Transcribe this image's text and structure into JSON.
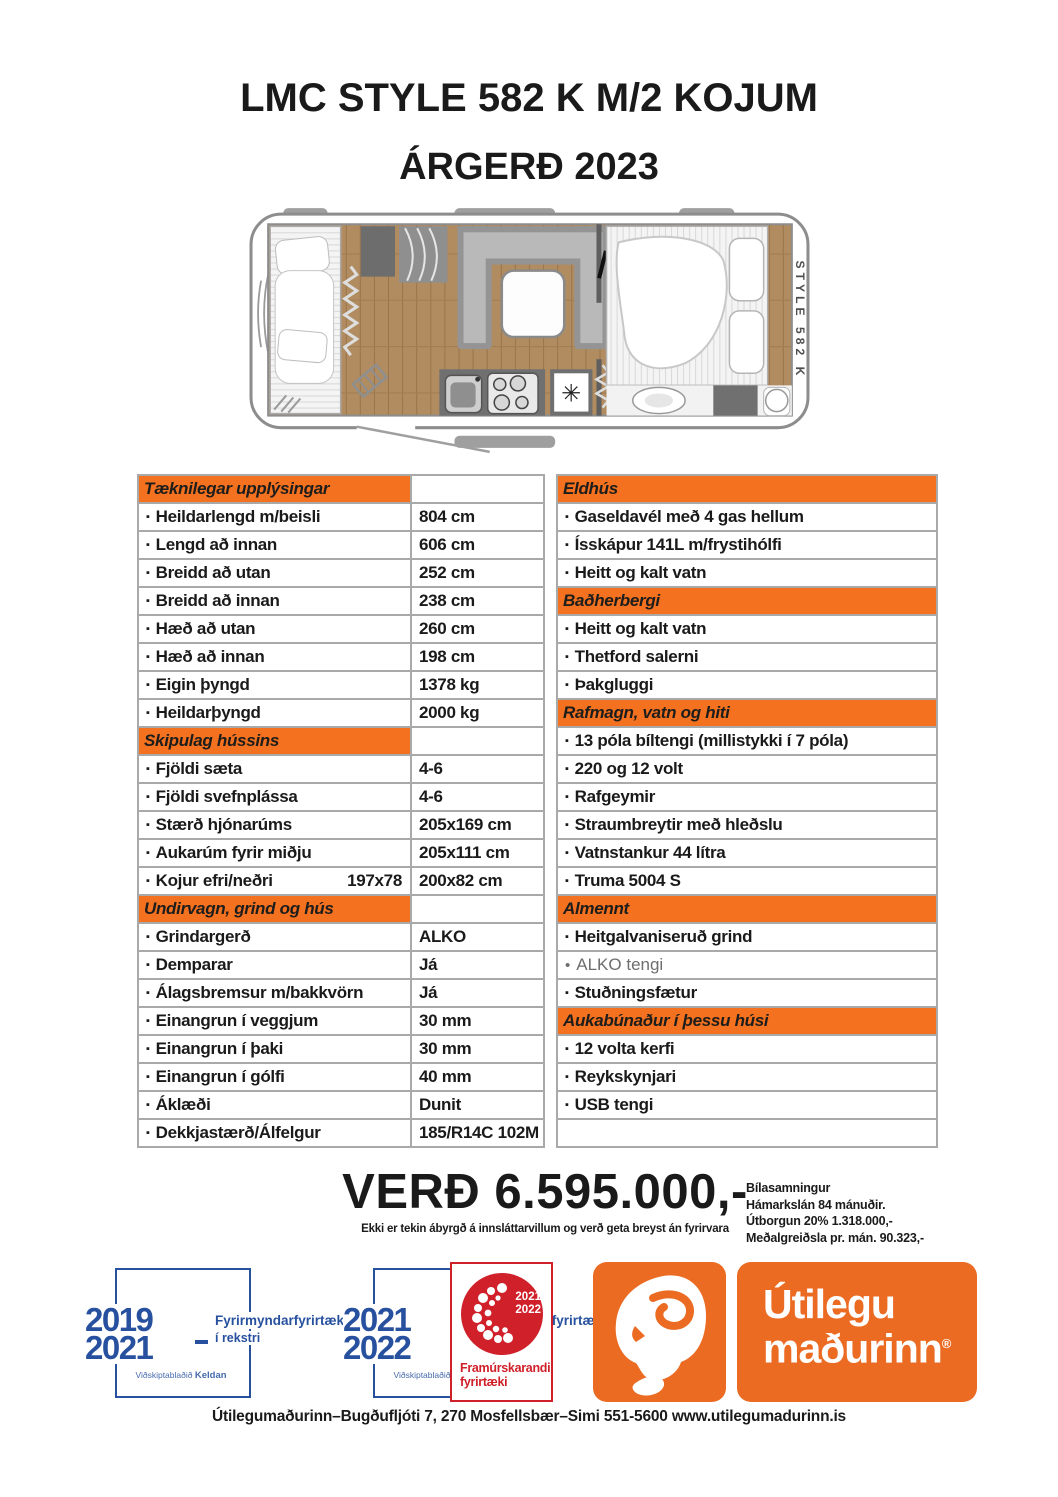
{
  "page": {
    "title_line1": "LMC STYLE 582 K M/2 KOJUM",
    "title_line2": "ÁRGERÐ 2023"
  },
  "floorplan": {
    "model_label": "STYLE 582 K",
    "tv_label": "TV",
    "freezer_symbol": "✳"
  },
  "bullets": {
    "square": "▪",
    "round": "•"
  },
  "specs": {
    "left": [
      {
        "type": "header",
        "label": "Tæknilegar upplýsingar"
      },
      {
        "type": "row",
        "label": "Heildarlengd m/beisli",
        "value": "804 cm"
      },
      {
        "type": "row",
        "label": "Lengd að innan",
        "value": "606 cm"
      },
      {
        "type": "row",
        "label": "Breidd að utan",
        "value": "252 cm"
      },
      {
        "type": "row",
        "label": "Breidd að innan",
        "value": "238 cm"
      },
      {
        "type": "row",
        "label": "Hæð að utan",
        "value": "260 cm"
      },
      {
        "type": "row",
        "label": "Hæð að innan",
        "value": "198 cm"
      },
      {
        "type": "row",
        "label": "Eigin þyngd",
        "value": "1378 kg"
      },
      {
        "type": "row",
        "label": "Heildarþyngd",
        "value": "2000 kg"
      },
      {
        "type": "header",
        "label": "Skipulag hússins"
      },
      {
        "type": "row",
        "label": "Fjöldi sæta",
        "value": "4-6"
      },
      {
        "type": "row",
        "label": "Fjöldi svefnplássa",
        "value": "4-6"
      },
      {
        "type": "row",
        "label": "Stærð hjónarúms",
        "value": "205x169 cm"
      },
      {
        "type": "row",
        "label": "Aukarúm fyrir miðju",
        "value": "205x111 cm"
      },
      {
        "type": "row",
        "label": "Kojur efri/neðri",
        "label2": "197x78",
        "value": "200x82 cm"
      },
      {
        "type": "header",
        "label": "Undirvagn, grind og hús"
      },
      {
        "type": "row",
        "label": "Grindargerð",
        "value": "ALKO"
      },
      {
        "type": "row",
        "label": "Demparar",
        "value": "Já"
      },
      {
        "type": "row",
        "label": "Álagsbremsur m/bakkvörn",
        "value": "Já"
      },
      {
        "type": "row",
        "label": "Einangrun í veggjum",
        "value": "30 mm"
      },
      {
        "type": "row",
        "label": "Einangrun í þaki",
        "value": "30 mm"
      },
      {
        "type": "row",
        "label": "Einangrun í gólfi",
        "value": "40 mm"
      },
      {
        "type": "row",
        "label": "Áklæði",
        "value": "Dunit"
      },
      {
        "type": "row",
        "label": "Dekkjastærð/Álfelgur",
        "value": "185/R14C 102M"
      }
    ],
    "right": [
      {
        "type": "header",
        "label": "Eldhús"
      },
      {
        "type": "row",
        "label": "Gaseldavél með 4 gas hellum"
      },
      {
        "type": "row",
        "label": "Ísskápur 141L m/frystihólfi"
      },
      {
        "type": "row",
        "label": "Heitt og kalt vatn"
      },
      {
        "type": "header",
        "label": "Baðherbergi"
      },
      {
        "type": "row",
        "label": "Heitt og kalt vatn"
      },
      {
        "type": "row",
        "label": "Thetford salerni"
      },
      {
        "type": "row",
        "label": "Þakgluggi"
      },
      {
        "type": "header",
        "label": "Rafmagn, vatn og hiti"
      },
      {
        "type": "row",
        "label": "13 póla bíltengi (millistykki í 7 póla)"
      },
      {
        "type": "row",
        "label": "220 og 12 volt"
      },
      {
        "type": "row",
        "label": "Rafgeymir"
      },
      {
        "type": "row",
        "label": "Straumbreytir með hleðslu"
      },
      {
        "type": "row",
        "label": "Vatnstankur 44 lítra"
      },
      {
        "type": "row",
        "label": "Truma 5004 S"
      },
      {
        "type": "header",
        "label": "Almennt"
      },
      {
        "type": "row",
        "label": "Heitgalvaniseruð grind"
      },
      {
        "type": "row",
        "label": "ALKO tengi",
        "muted": true
      },
      {
        "type": "row",
        "label": "Stuðningsfætur"
      },
      {
        "type": "header",
        "label": "Aukabúnaður í þessu húsi"
      },
      {
        "type": "row",
        "label": "12 volta kerfi"
      },
      {
        "type": "row",
        "label": "Reykskynjari"
      },
      {
        "type": "row",
        "label": "USB tengi"
      },
      {
        "type": "empty"
      }
    ]
  },
  "price": {
    "amount_label": "VERÐ 6.595.000,-",
    "disclaimer": "Ekki er tekin ábyrgð á innsláttarvillum og verð geta breyst án fyrirvara"
  },
  "financing": {
    "lines": [
      "Bílasamningur",
      "Hámarkslán 84 mánuðir.",
      "Útborgun 20% 1.318.000,-",
      "Meðalgreiðsla pr. mán. 90.323,-"
    ]
  },
  "badges": {
    "award1": {
      "year_top": "2019",
      "year_bottom": "2021",
      "title": "Fyrirmyndarfyrirtæki",
      "subtitle": "í rekstri",
      "source": "Viðskiptablaðið",
      "brand": "Keldan"
    },
    "award2": {
      "year_top": "2021",
      "year_bottom": "2022",
      "title": "Fyrirmyndarfyrirtæki",
      "subtitle": "í rekstri",
      "source": "Viðskiptablaðið",
      "brand": "Keldan"
    },
    "excellence": {
      "year_top": "2021",
      "year_bottom": "2022",
      "label_line1": "Framúrskarandi",
      "label_line2": "fyrirtæki"
    },
    "brand_wordmark": {
      "line1": "Útilegu",
      "line2": "maðurinn",
      "registered": "®"
    }
  },
  "footer": {
    "contact_line": "Útilegumaðurinn–Bugðufljóti 7, 270 Mosfellsbær–Simi 551-5600 www.utilegumadurinn.is"
  },
  "colors": {
    "accent_orange": "#F4711F",
    "logo_orange": "#EB6B23",
    "award_blue": "#27519F",
    "excellence_red": "#D0202A",
    "table_border": "#A9A9A9",
    "wood_floor": "#B18C60"
  }
}
